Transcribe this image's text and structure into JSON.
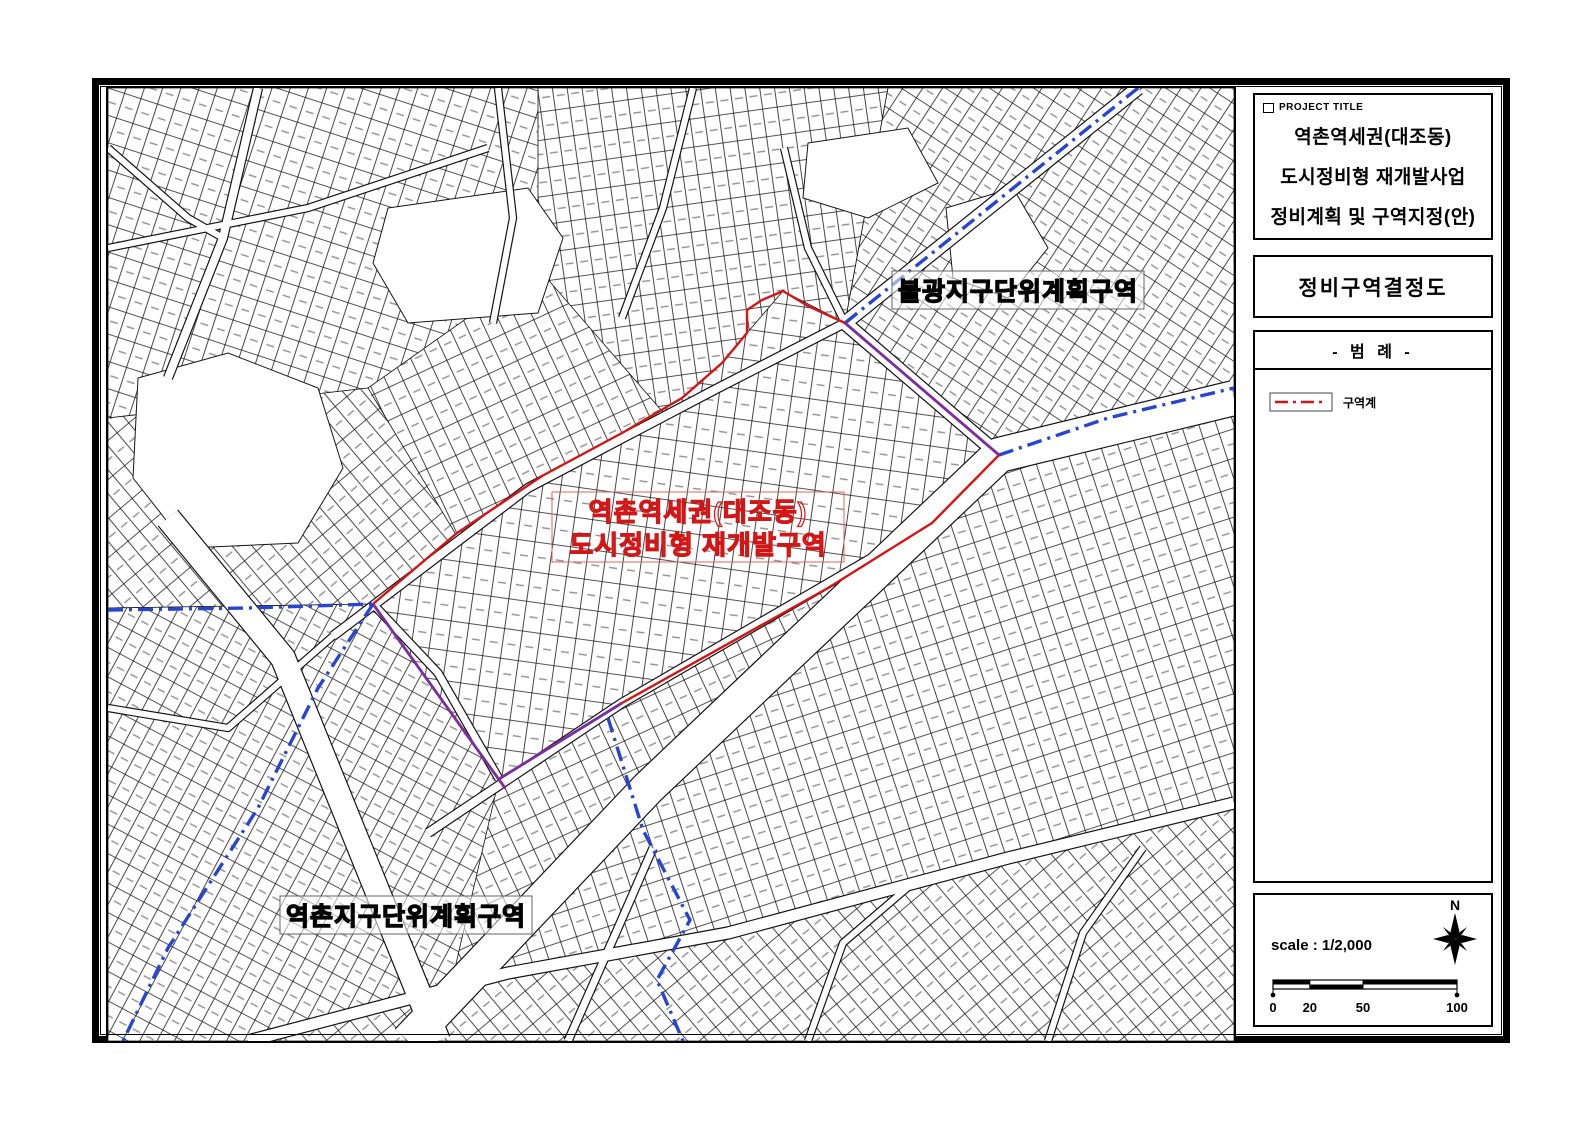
{
  "sheet": {
    "project_title_label": "PROJECT TITLE",
    "title_lines": [
      "역촌역세권(대조동)",
      "도시정비형 재개발사업",
      "정비계획 및 구역지정(안)"
    ],
    "drawing_name": "정비구역결정도",
    "legend": {
      "header": "- 범  례 -",
      "items": [
        {
          "label": "구역계",
          "line_color": "#d21616",
          "line_style": "dash-dot"
        }
      ]
    },
    "scale": {
      "text": "scale : 1/2,000",
      "ratio": "1/2,000",
      "ticks": [
        "0",
        "20",
        "50",
        "100"
      ],
      "north_label": "N"
    }
  },
  "map": {
    "labels": {
      "bulgwang_district": "불광지구단위계획구역",
      "yeokchon_district": "역촌지구단위계획구역",
      "zone_line1": "역촌역세권(대조동)",
      "zone_line2": "도시정비형 재개발구역"
    },
    "colors": {
      "zone_boundary": "#d21616",
      "district_boundary": "#2745cf",
      "overlap": "#7a2f9e",
      "parcel_line": "#1a1a1a"
    }
  }
}
